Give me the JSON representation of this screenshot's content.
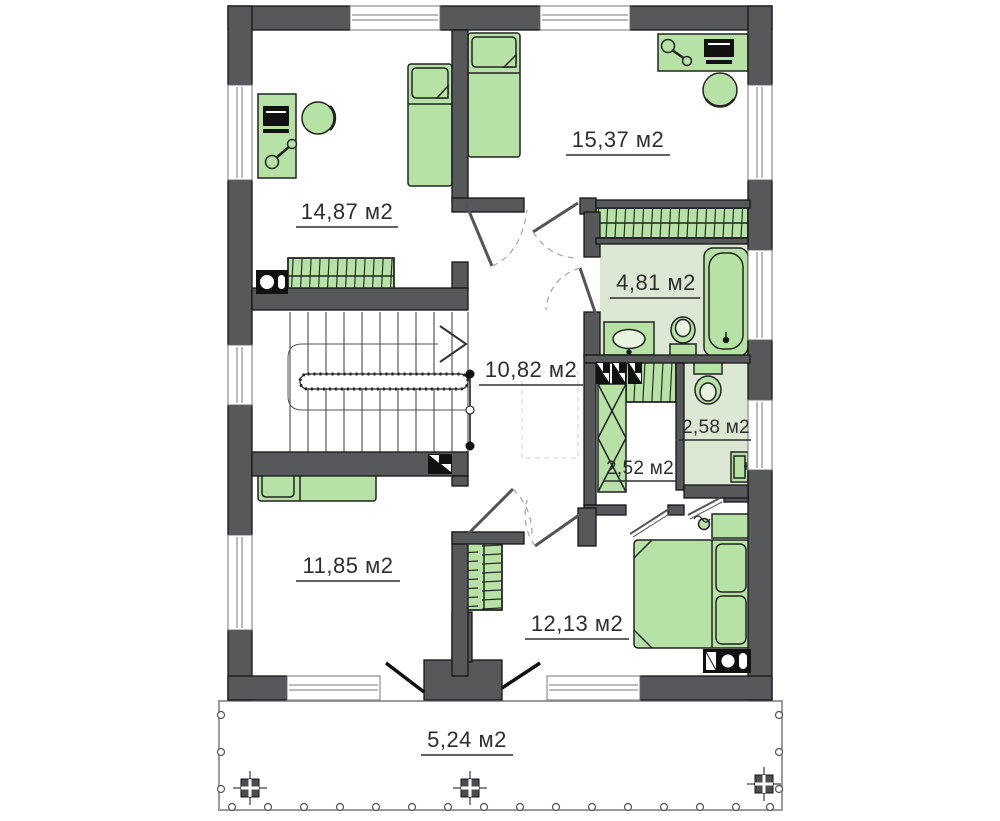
{
  "rooms": [
    {
      "id": "bedroom-top-left",
      "area": "14,87 м2"
    },
    {
      "id": "bedroom-top-right",
      "area": "15,37 м2"
    },
    {
      "id": "bathroom",
      "area": "4,81 м2"
    },
    {
      "id": "hallway",
      "area": "10,82 м2"
    },
    {
      "id": "wc",
      "area": "2,58 м2"
    },
    {
      "id": "closet",
      "area": "2,52 м2"
    },
    {
      "id": "bedroom-bottom-left",
      "area": "11,85 м2"
    },
    {
      "id": "bedroom-master",
      "area": "12,13 м2"
    },
    {
      "id": "terrace",
      "area": "5,24 м2"
    }
  ],
  "colors": {
    "wall": "#57585a",
    "outline": "#161616",
    "furniture_fill": "#b7e2a6",
    "floor_tint": "#dce8d4",
    "text": "#2e2e2e",
    "terrace_line": "#9b9b9b"
  }
}
